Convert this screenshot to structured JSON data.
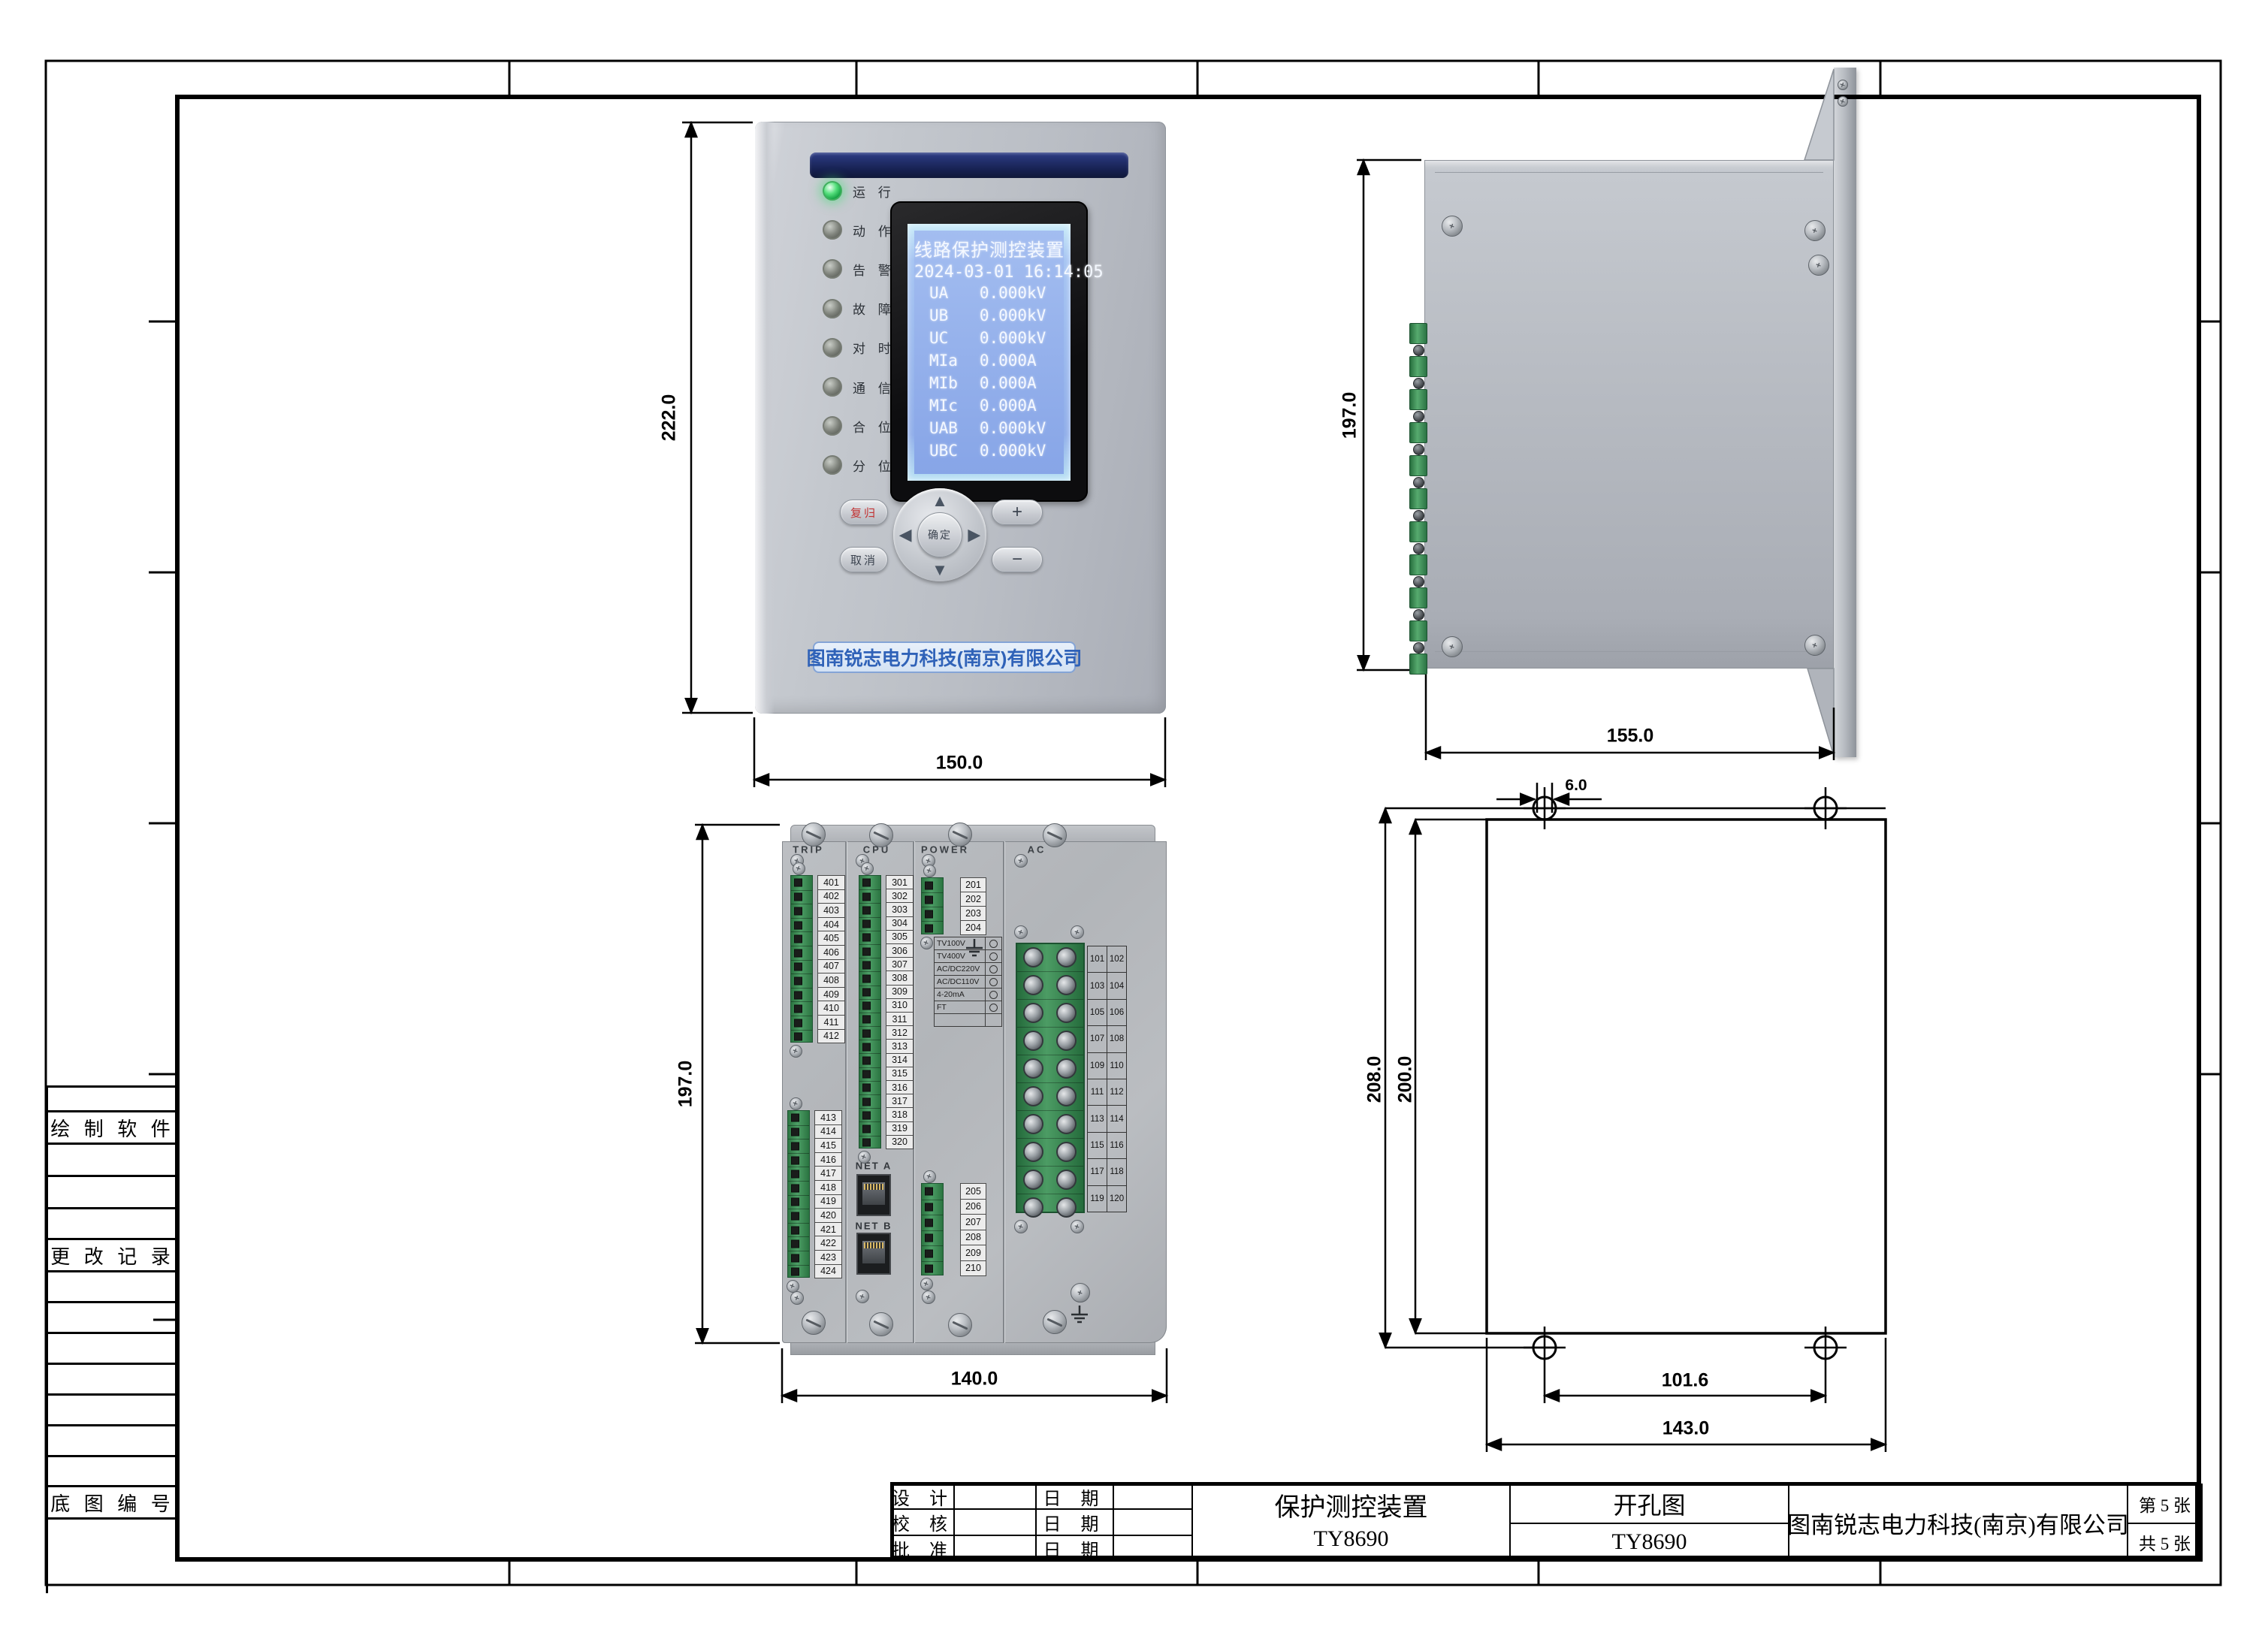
{
  "frame": {
    "sidebar_labels": {
      "software": "绘 制 软 件",
      "changes": "更 改 记 录",
      "base_no": "底 图 编 号"
    },
    "title_block": {
      "rows": [
        {
          "role": "设  计",
          "date": "日  期"
        },
        {
          "role": "校  核",
          "date": "日  期"
        },
        {
          "role": "批  准",
          "date": "日  期"
        }
      ],
      "product_name": "保护测控装置",
      "product_model": "TY8690",
      "drawing_name": "开孔图",
      "drawing_model": "TY8690",
      "company": "图南锐志电力科技(南京)有限公司",
      "sheet_index": "第  5  张",
      "sheet_count": "共  5  张"
    }
  },
  "front_view": {
    "dim_height": "222.0",
    "dim_width": "150.0",
    "leds": [
      {
        "label": "运 行",
        "on": true
      },
      {
        "label": "动 作",
        "on": false
      },
      {
        "label": "告 警",
        "on": false
      },
      {
        "label": "故 障",
        "on": false
      },
      {
        "label": "对 时",
        "on": false
      },
      {
        "label": "通 信",
        "on": false
      },
      {
        "label": "合 位",
        "on": false
      },
      {
        "label": "分 位",
        "on": false
      }
    ],
    "lcd_title": "线路保护测控装置",
    "lcd_datetime": "2024-03-01 16:14:05",
    "lcd_rows": [
      {
        "name": "UA",
        "value": "0.000",
        "unit": "kV"
      },
      {
        "name": "UB",
        "value": "0.000",
        "unit": "kV"
      },
      {
        "name": "UC",
        "value": "0.000",
        "unit": "kV"
      },
      {
        "name": "MIa",
        "value": "0.000",
        "unit": "A"
      },
      {
        "name": "MIb",
        "value": "0.000",
        "unit": "A"
      },
      {
        "name": "MIc",
        "value": "0.000",
        "unit": "A"
      },
      {
        "name": "UAB",
        "value": "0.000",
        "unit": "kV"
      },
      {
        "name": "UBC",
        "value": "0.000",
        "unit": "kV"
      }
    ],
    "btn_reset": "复归",
    "btn_cancel": "取消",
    "btn_confirm": "确定",
    "btn_plus": "+",
    "btn_minus": "−",
    "brand": "图南锐志电力科技(南京)有限公司"
  },
  "side_view": {
    "dim_height": "197.0",
    "dim_width": "155.0"
  },
  "back_view": {
    "dim_height": "197.0",
    "dim_width": "140.0",
    "modules": [
      "TRIP",
      "CPU",
      "POWER",
      "AC"
    ],
    "trip_top": [
      "401",
      "402",
      "403",
      "404",
      "405",
      "406",
      "407",
      "408",
      "409",
      "410",
      "411",
      "412"
    ],
    "trip_bottom": [
      "413",
      "414",
      "415",
      "416",
      "417",
      "418",
      "419",
      "420",
      "421",
      "422",
      "423",
      "424"
    ],
    "cpu": [
      "301",
      "302",
      "303",
      "304",
      "305",
      "306",
      "307",
      "308",
      "309",
      "310",
      "311",
      "312",
      "313",
      "314",
      "315",
      "316",
      "317",
      "318",
      "319",
      "320"
    ],
    "power_top": [
      "201",
      "202",
      "203",
      "204"
    ],
    "power_bottom": [
      "205",
      "206",
      "207",
      "208",
      "209",
      "210"
    ],
    "net_a": "NET A",
    "net_b": "NET B",
    "config_options": [
      "TV100V",
      "TV400V",
      "AC/DC220V",
      "AC/DC110V",
      "4-20mA",
      "FT"
    ],
    "ac_pairs": [
      [
        "101",
        "102"
      ],
      [
        "103",
        "104"
      ],
      [
        "105",
        "106"
      ],
      [
        "107",
        "108"
      ],
      [
        "109",
        "110"
      ],
      [
        "111",
        "112"
      ],
      [
        "113",
        "114"
      ],
      [
        "115",
        "116"
      ],
      [
        "117",
        "118"
      ],
      [
        "119",
        "120"
      ]
    ]
  },
  "drill_view": {
    "dim_hole": "6.0",
    "dim_outer": "208.0",
    "dim_inner": "200.0",
    "dim_holes_h": "101.6",
    "dim_width": "143.0"
  }
}
